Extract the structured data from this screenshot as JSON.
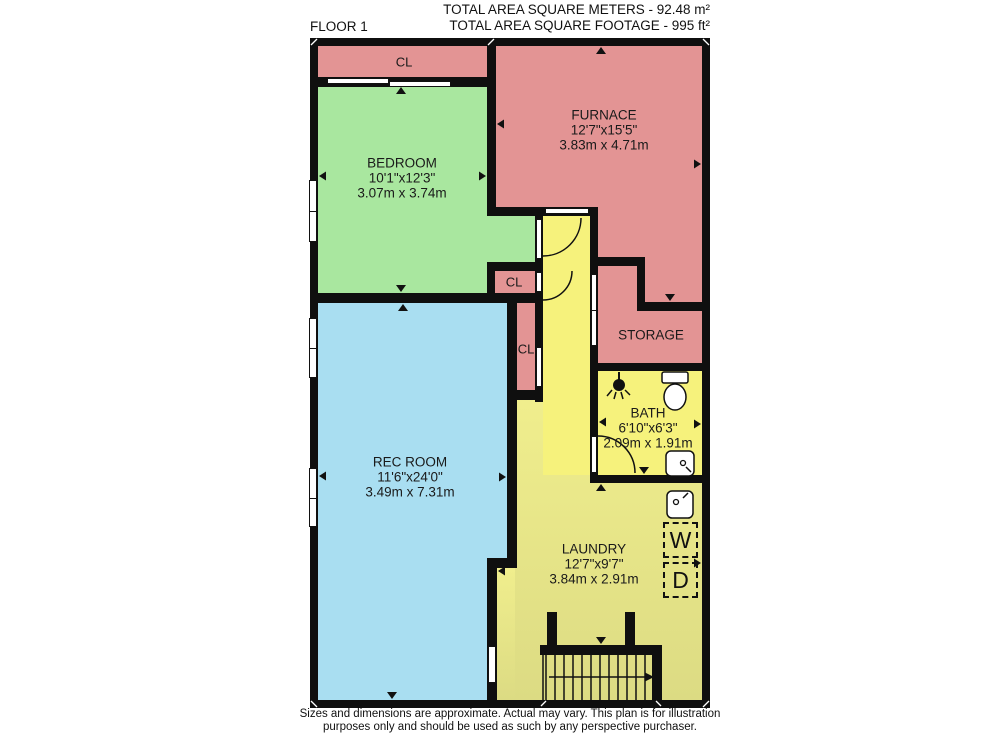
{
  "header": {
    "floor_label": "FLOOR 1",
    "total_meters": "TOTAL AREA SQUARE METERS - 92.48 m²",
    "total_feet": "TOTAL AREA SQUARE FOOTAGE - 995 ft²"
  },
  "footer": {
    "line1": "Sizes and dimensions are approximate. Actual may vary. This plan is for illustration",
    "line2": "purposes only and should be used as such by any perspective purchaser."
  },
  "rooms": {
    "bedroom": {
      "name": "BEDROOM",
      "dims_ft": "10'1\"x12'3\"",
      "dims_m": "3.07m x 3.74m",
      "color": "#a9e79f"
    },
    "furnace": {
      "name": "FURNACE",
      "dims_ft": "12'7\"x15'5\"",
      "dims_m": "3.83m x 4.71m",
      "color": "#e39494"
    },
    "rec_room": {
      "name": "REC ROOM",
      "dims_ft": "11'6\"x24'0\"",
      "dims_m": "3.49m x 7.31m",
      "color": "#a9def1"
    },
    "bath": {
      "name": "BATH",
      "dims_ft": "6'10\"x6'3\"",
      "dims_m": "2.09m x 1.91m",
      "color": "#f6f27c"
    },
    "laundry": {
      "name": "LAUNDRY",
      "dims_ft": "12'7\"x9'7\"",
      "dims_m": "3.84m x 2.91m",
      "color": "#ebe98f"
    },
    "storage": {
      "name": "STORAGE",
      "color": "#e39494"
    },
    "closet_top": {
      "name": "CL"
    },
    "closet_mid": {
      "name": "CL"
    },
    "closet_lower": {
      "name": "CL"
    },
    "hallway": {
      "color": "#f6f27c"
    }
  },
  "appliances": {
    "washer": "W",
    "dryer": "D"
  },
  "colors": {
    "wall": "#0f0f0f",
    "pink": "#e39494",
    "green": "#a9e79f",
    "blue": "#a9def1",
    "yellow_bright": "#f6f27c",
    "yellow_laundry": "#ebe98f"
  }
}
